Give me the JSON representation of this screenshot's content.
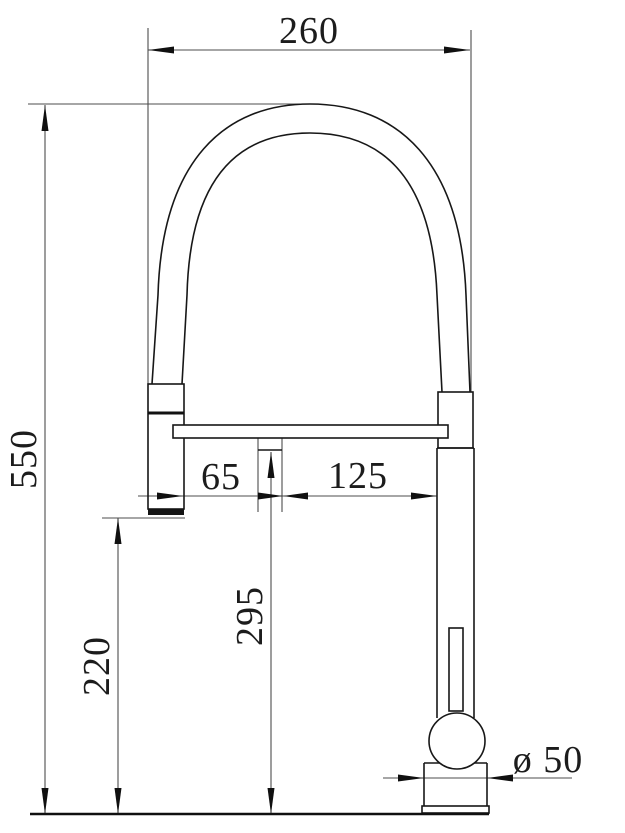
{
  "drawing": {
    "dimensions": {
      "top_width": "260",
      "total_height": "550",
      "connector_height": "220",
      "spout_outlet_height": "295",
      "spout_left_offset": "65",
      "spout_to_column": "125",
      "base_diameter": "ø 50"
    }
  }
}
